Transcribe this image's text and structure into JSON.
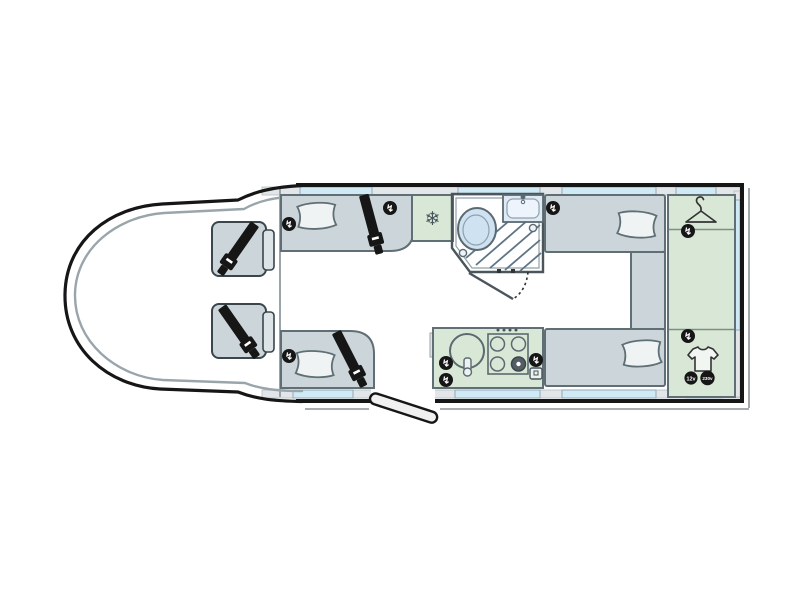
{
  "floorplan": {
    "badges": {
      "v12": "12v",
      "v230": "230v"
    },
    "icons": {
      "fridge": "❄",
      "socket": "↯"
    },
    "colors": {
      "outline": "#161616",
      "furniture_gray": "#ccd6da",
      "cabinet_green": "#d9e8d6",
      "window_blue": "#cfe9f5",
      "bathroom_blue": "#c7ddf0",
      "shower_blue": "#cfe2f2",
      "wall_band_gray": "#e2e6e8",
      "pillow_white": "#f0f3f4",
      "badge_black": "#161616"
    }
  }
}
